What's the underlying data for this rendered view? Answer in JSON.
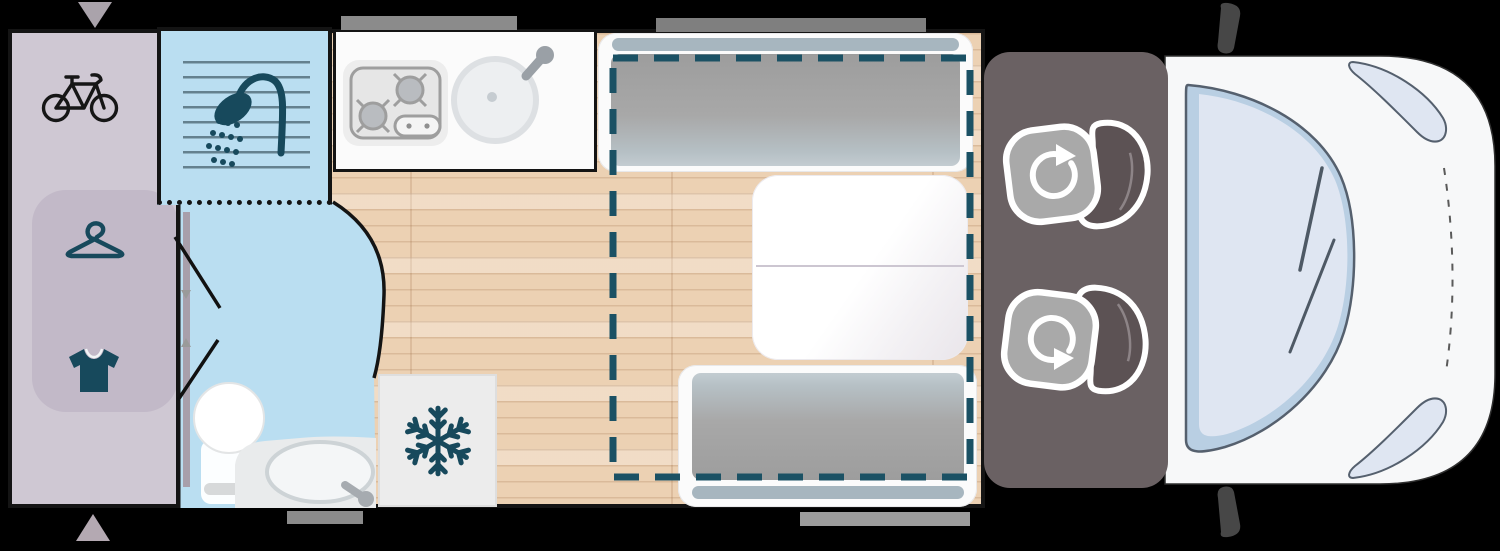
{
  "floorplan": {
    "vehicle": "campervan-top-view",
    "areas": {
      "garage": {
        "name": "rear-garage",
        "icons": [
          "bicycle",
          "clothes-hanger",
          "t-shirt"
        ]
      },
      "bathroom": {
        "name": "washroom",
        "icons": [
          "shower"
        ],
        "fixtures": [
          "shower-tray",
          "toilet",
          "washbasin-counter",
          "folding-door"
        ]
      },
      "kitchen": {
        "name": "kitchen",
        "fixtures": [
          "two-burner-hob",
          "round-sink-with-tap"
        ]
      },
      "fridge": {
        "name": "refrigerator",
        "icons": [
          "snowflake"
        ]
      },
      "dinette": {
        "name": "dinette",
        "fixtures": [
          "bench-seat-front",
          "folding-table",
          "bench-seat-rear"
        ],
        "overlay": "drop-down-bed-dashed-outline"
      },
      "cab": {
        "name": "driver-cab",
        "fixtures": [
          "swivel-seat-driver",
          "swivel-seat-passenger",
          "windshield",
          "headlight-left",
          "headlight-right",
          "wing-mirror-left",
          "wing-mirror-right"
        ]
      }
    },
    "markers": {
      "window_bars": 4,
      "entry_arrows": 2
    }
  },
  "colors": {
    "bg": "#000000",
    "outline": "#141414",
    "wood": "#ecd1b3",
    "garage": "#cfc8d3",
    "wardrobe": "#c2b9c8",
    "bath": "#badef1",
    "showerline": "#47626e",
    "teal": "#17495c",
    "white": "#fbfbfb",
    "appliance": "#ececec",
    "applianceline": "#9e9e9e",
    "fixture": "#e9ebec",
    "fixtureline": "#cdd3d6",
    "cushion": "#a6a6a6",
    "cushionlight": "#c3ccd1",
    "headrest": "#a7b6bf",
    "tabledivider": "#ccc6d1",
    "beddash": "#1b5164",
    "seatsarea": "#6a6163",
    "seatcushion": "#a9a9a9",
    "seatback": "#5c5254",
    "cab": "#f7f8f9",
    "glass": "#dfe6f2",
    "glassedge": "#b9cfe3",
    "glassline": "#55606e",
    "windowbar": "#8b8b8b",
    "mirror": "#474747",
    "tri": "#aaa3ab"
  }
}
